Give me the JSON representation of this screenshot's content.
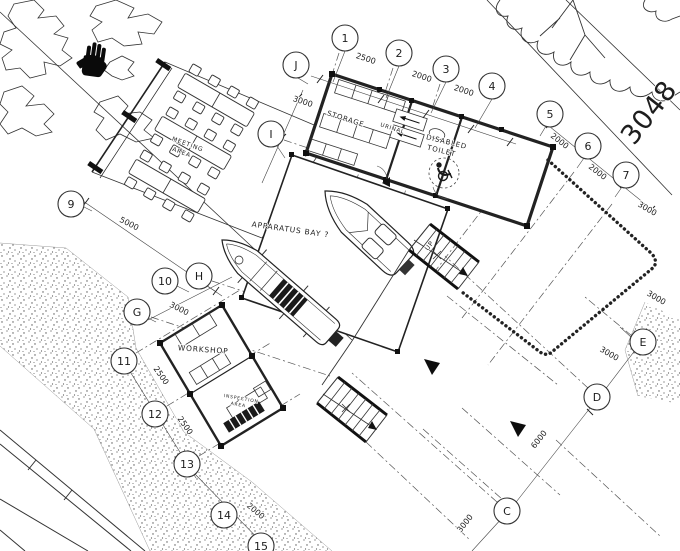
{
  "colors": {
    "ink": "#2b2b2b",
    "paper": "#ffffff"
  },
  "lot_number": "3048",
  "grid_bubbles": [
    {
      "label": "1",
      "x": 345,
      "y": 38
    },
    {
      "label": "2",
      "x": 399,
      "y": 53
    },
    {
      "label": "3",
      "x": 446,
      "y": 69
    },
    {
      "label": "4",
      "x": 492,
      "y": 86
    },
    {
      "label": "5",
      "x": 550,
      "y": 114
    },
    {
      "label": "6",
      "x": 588,
      "y": 146
    },
    {
      "label": "7",
      "x": 626,
      "y": 175
    },
    {
      "label": "J",
      "x": 296,
      "y": 65
    },
    {
      "label": "I",
      "x": 271,
      "y": 134
    },
    {
      "label": "H",
      "x": 199,
      "y": 276
    },
    {
      "label": "G",
      "x": 137,
      "y": 312
    },
    {
      "label": "9",
      "x": 71,
      "y": 204
    },
    {
      "label": "10",
      "x": 165,
      "y": 281
    },
    {
      "label": "11",
      "x": 124,
      "y": 361
    },
    {
      "label": "12",
      "x": 155,
      "y": 414
    },
    {
      "label": "13",
      "x": 187,
      "y": 464
    },
    {
      "label": "14",
      "x": 224,
      "y": 515
    },
    {
      "label": "15",
      "x": 261,
      "y": 546
    },
    {
      "label": "E",
      "x": 643,
      "y": 342
    },
    {
      "label": "D",
      "x": 597,
      "y": 397
    },
    {
      "label": "C",
      "x": 507,
      "y": 511
    }
  ],
  "dimensions": [
    {
      "text": "2500",
      "x": 365,
      "y": 61,
      "rot": 18
    },
    {
      "text": "2000",
      "x": 421,
      "y": 79,
      "rot": 18
    },
    {
      "text": "2000",
      "x": 463,
      "y": 93,
      "rot": 18
    },
    {
      "text": "3000",
      "x": 302,
      "y": 104,
      "rot": 18
    },
    {
      "text": "2000",
      "x": 558,
      "y": 143,
      "rot": 38
    },
    {
      "text": "2000",
      "x": 596,
      "y": 174,
      "rot": 38
    },
    {
      "text": "3000",
      "x": 646,
      "y": 211,
      "rot": 30
    },
    {
      "text": "3000",
      "x": 655,
      "y": 300,
      "rot": 30
    },
    {
      "text": "3000",
      "x": 608,
      "y": 356,
      "rot": 30
    },
    {
      "text": "6000",
      "x": 541,
      "y": 441,
      "rot": -52
    },
    {
      "text": "3000",
      "x": 467,
      "y": 525,
      "rot": -52
    },
    {
      "text": "5000",
      "x": 128,
      "y": 226,
      "rot": 27
    },
    {
      "text": "3000",
      "x": 178,
      "y": 311,
      "rot": 27
    },
    {
      "text": "2500",
      "x": 159,
      "y": 377,
      "rot": 55
    },
    {
      "text": "2500",
      "x": 183,
      "y": 427,
      "rot": 55
    },
    {
      "text": "2000",
      "x": 254,
      "y": 513,
      "rot": 40
    }
  ],
  "labels": [
    {
      "text": "STORAGE",
      "x": 345,
      "y": 121,
      "rot": 18,
      "size": 7,
      "name": "room-label-storage"
    },
    {
      "text": "URINAL",
      "x": 392,
      "y": 130,
      "rot": 18,
      "size": 5.5,
      "name": "room-label-urinal"
    },
    {
      "text": "DISABLED",
      "x": 446,
      "y": 144,
      "rot": 14,
      "size": 7,
      "name": "room-label-disabled"
    },
    {
      "text": "TOILET",
      "x": 441,
      "y": 153,
      "rot": 14,
      "size": 7,
      "name": "room-label-toilet"
    },
    {
      "text": "APPARATUS BAY ?",
      "x": 290,
      "y": 232,
      "rot": 8,
      "size": 7.5,
      "name": "room-label-apparatus-bay"
    },
    {
      "text": "WORKSHOP",
      "x": 203,
      "y": 352,
      "rot": 4,
      "size": 7.5,
      "name": "room-label-workshop"
    },
    {
      "text": "MEETING",
      "x": 187,
      "y": 146,
      "rot": 20,
      "size": 6,
      "name": "room-label-meeting"
    },
    {
      "text": "AREA",
      "x": 181,
      "y": 154,
      "rot": 20,
      "size": 6,
      "name": "room-label-meeting-area"
    },
    {
      "text": "INSPECTION",
      "x": 241,
      "y": 400,
      "rot": 10,
      "size": 4.5,
      "name": "room-label-inspection"
    },
    {
      "text": "AREA",
      "x": 238,
      "y": 406,
      "rot": 10,
      "size": 4.5,
      "name": "room-label-inspection-area"
    },
    {
      "text": "UP",
      "x": 431,
      "y": 247,
      "rot": -52,
      "size": 6.5,
      "name": "stair-up-label"
    },
    {
      "text": "3048",
      "x": 656,
      "y": 118,
      "rot": -52,
      "size": 27,
      "name": "lot-number-label"
    }
  ]
}
